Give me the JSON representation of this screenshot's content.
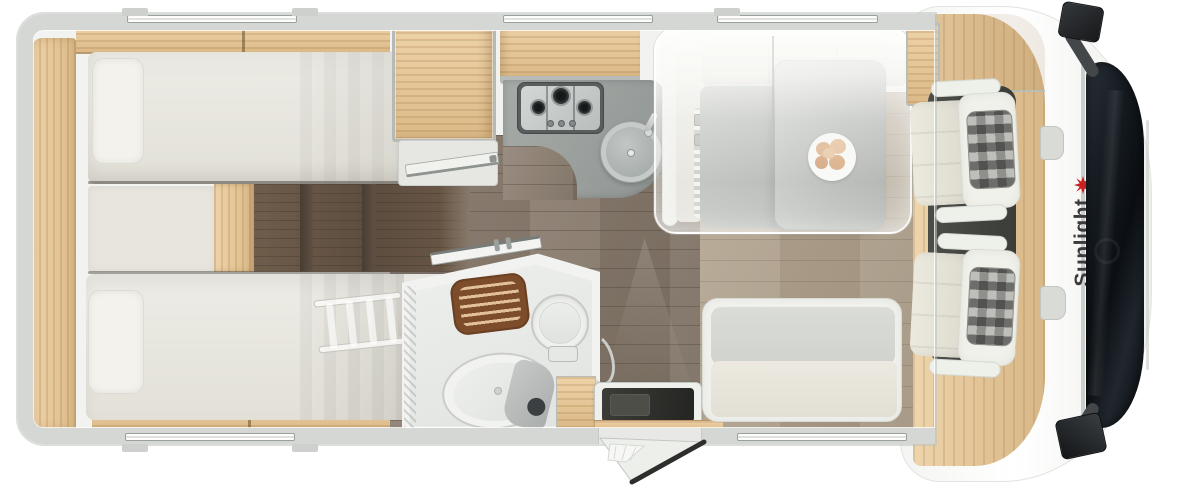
{
  "title": "Sunlight motorhome floor plan, top view",
  "brand": {
    "logo_text": "Sunlight",
    "logo_text_color": "#3a3a3a",
    "logo_sun_color": "#c92121"
  },
  "vehicle": {
    "areas": [
      {
        "name": "rear-bedroom",
        "features": [
          "twin single beds",
          "pillows",
          "center cushion",
          "dark wood steps between beds",
          "translucent bunk ladder",
          "wardrobe",
          "overhead oak shelves"
        ]
      },
      {
        "name": "kitchen",
        "features": [
          "3-burner gas hob with 3 control knobs",
          "round sink with faucet",
          "gray L-shaped counter",
          "oak overhead cabinet"
        ]
      },
      {
        "name": "bathroom",
        "features": [
          "shower with brown slatted wooden mat",
          "round toilet",
          "oval washbasin",
          "shower column",
          "small oak cabinet",
          "open bathroom door"
        ]
      },
      {
        "name": "dinette",
        "features": [
          "gray table with extension leaf",
          "plate with bread rolls",
          "bench seats on three sides",
          "translucent drop-down bed overlay"
        ]
      },
      {
        "name": "entrance",
        "features": [
          "entry step well",
          "open entry door",
          "oak threshold strip"
        ]
      },
      {
        "name": "cab",
        "features": [
          "driver seat",
          "passenger seat",
          "checkered headrests",
          "dark windshield",
          "two exterior mirrors",
          "Sunlight logo on hood"
        ]
      }
    ],
    "windows": {
      "top_count": 3,
      "bottom_count": 2
    },
    "hob_burner_count": 3,
    "entry_door_state": "open"
  },
  "colors": {
    "body_wall": "#d4d7d3",
    "interior": "#f2f3f0",
    "oak_furniture": "#e5c492",
    "floor_corridor": "#87796b",
    "floor_dinette": "#b0a290",
    "mattress": "#e8e6de",
    "counter": "#9ba19e",
    "table": "#aab0ad",
    "windshield": "#12171c",
    "steps_dark_wood": "#5d4d3f"
  }
}
